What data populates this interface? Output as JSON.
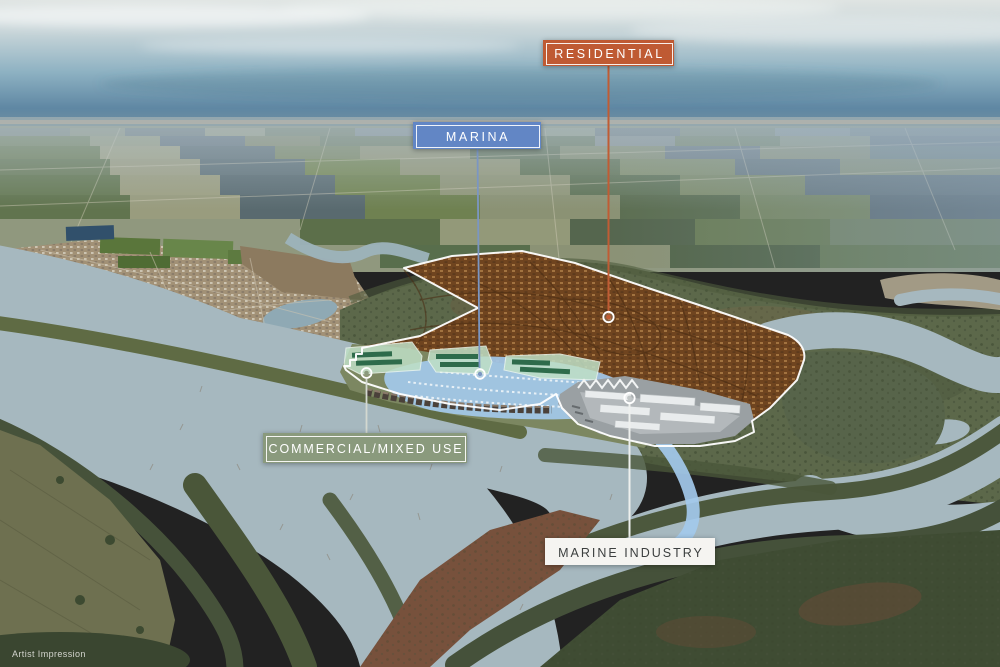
{
  "zone_labels": {
    "residential": {
      "text": "RESIDENTIAL",
      "box_color": "#bf5a33",
      "text_color": "#ffffff",
      "line_color": "#c05c34"
    },
    "marina": {
      "text": "MARINA",
      "box_color": "#6286c5",
      "text_color": "#ffffff",
      "line_color": "#7b96c2"
    },
    "commercial": {
      "text": "COMMERCIAL/MIXED USE",
      "box_color": "#8a9a7d",
      "text_color": "#ffffff",
      "line_color": "#d3d8d0"
    },
    "marine_industry": {
      "text": "MARINE INDUSTRY",
      "box_color": "#f5f4f1",
      "text_color": "#3c3f3f",
      "line_color": "#eef0ee",
      "dot_color": "#c2c7c7"
    }
  },
  "watermark": "Artist Impression"
}
